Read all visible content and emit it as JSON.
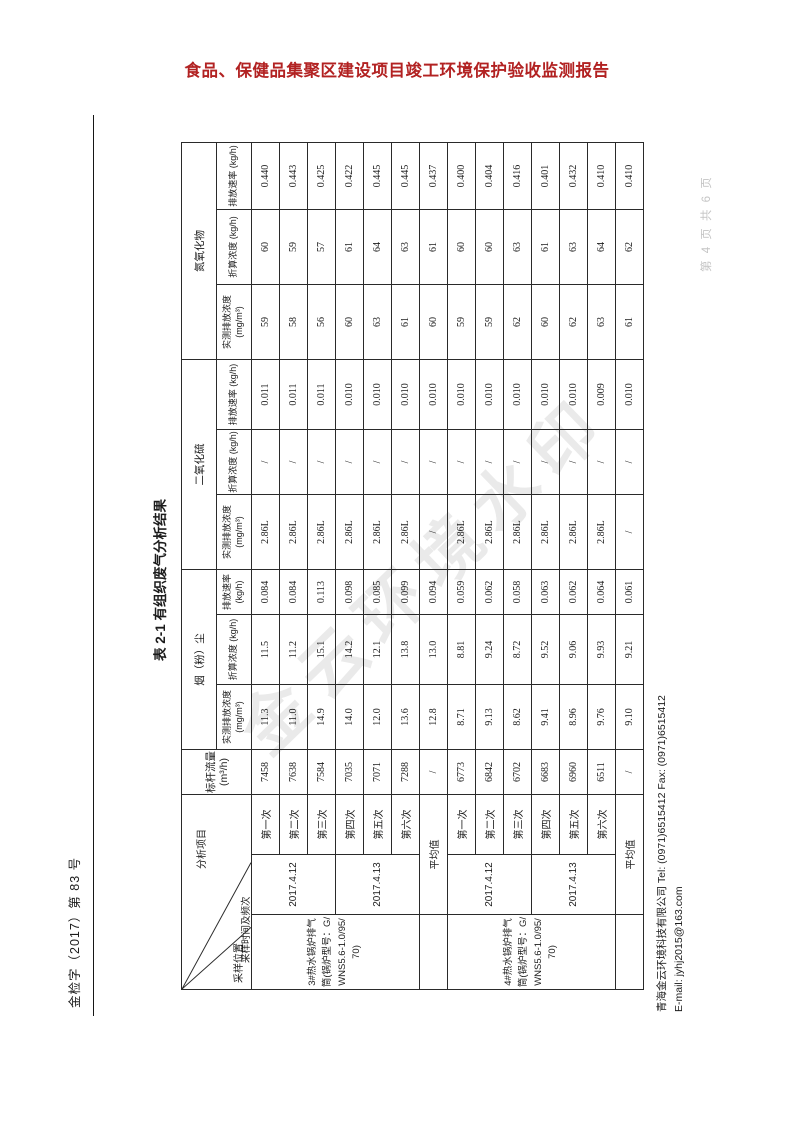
{
  "page": {
    "doc_header": "食品、保健品集聚区建设项目竣工环境保护验收监测报告",
    "ref_number": "金检字（2017）第 83 号",
    "page_number": "第 4 页 共 6 页",
    "watermark": "金云环境水印",
    "footer_line1": "青海金云环境科技有限公司 Tel: (0971)6515412  Fax: (0971)6515412",
    "footer_line2": "E-mail: jyhj2015@163.com"
  },
  "colors": {
    "doc_header_red": "#b22222",
    "table_border": "#2a2a2a",
    "watermark_gray": "rgba(125,125,125,0.16)"
  },
  "table": {
    "title": "表 2-1 有组织废气分析结果",
    "header": {
      "diag": [
        "采样位置",
        "采样时间及频次",
        "分析项目"
      ],
      "flow_label": "标杆流量 (m³/h)",
      "groups": [
        "烟（粉）尘",
        "二氧化硫",
        "氮氧化物"
      ],
      "sub": [
        "实测排放浓度 (mg/m³)",
        "折算浓度 (kg/h)",
        "排放速率 (kg/h)"
      ]
    },
    "sections": [
      {
        "location": "3#热水锅炉排气筒(锅炉型号：G/WNS5.6-1.0/95/70)",
        "dates": [
          {
            "date": "2017.4.12",
            "rows": [
              {
                "seq": "第一次",
                "flow": "7458",
                "dust": [
                  "11.3",
                  "11.5",
                  "0.084"
                ],
                "so2": [
                  "2.86L",
                  "/",
                  "0.011"
                ],
                "nox": [
                  "59",
                  "60",
                  "0.440"
                ]
              },
              {
                "seq": "第二次",
                "flow": "7638",
                "dust": [
                  "11.0",
                  "11.2",
                  "0.084"
                ],
                "so2": [
                  "2.86L",
                  "/",
                  "0.011"
                ],
                "nox": [
                  "58",
                  "59",
                  "0.443"
                ]
              },
              {
                "seq": "第三次",
                "flow": "7584",
                "dust": [
                  "14.9",
                  "15.1",
                  "0.113"
                ],
                "so2": [
                  "2.86L",
                  "/",
                  "0.011"
                ],
                "nox": [
                  "56",
                  "57",
                  "0.425"
                ]
              }
            ]
          },
          {
            "date": "2017.4.13",
            "rows": [
              {
                "seq": "第四次",
                "flow": "7035",
                "dust": [
                  "14.0",
                  "14.2",
                  "0.098"
                ],
                "so2": [
                  "2.86L",
                  "/",
                  "0.010"
                ],
                "nox": [
                  "60",
                  "61",
                  "0.422"
                ]
              },
              {
                "seq": "第五次",
                "flow": "7071",
                "dust": [
                  "12.0",
                  "12.1",
                  "0.085"
                ],
                "so2": [
                  "2.86L",
                  "/",
                  "0.010"
                ],
                "nox": [
                  "63",
                  "64",
                  "0.445"
                ]
              },
              {
                "seq": "第六次",
                "flow": "7288",
                "dust": [
                  "13.6",
                  "13.8",
                  "0.099"
                ],
                "so2": [
                  "2.86L",
                  "/",
                  "0.010"
                ],
                "nox": [
                  "61",
                  "63",
                  "0.445"
                ]
              }
            ]
          }
        ],
        "average": {
          "label": "平均值",
          "flow": "/",
          "dust": [
            "12.8",
            "13.0",
            "0.094"
          ],
          "so2": [
            "/",
            "/",
            "0.010"
          ],
          "nox": [
            "60",
            "61",
            "0.437"
          ]
        }
      },
      {
        "location": "4#热水锅炉排气筒(锅炉型号：G/WNS5.6-1.0/95/70)",
        "dates": [
          {
            "date": "2017.4.12",
            "rows": [
              {
                "seq": "第一次",
                "flow": "6773",
                "dust": [
                  "8.71",
                  "8.81",
                  "0.059"
                ],
                "so2": [
                  "2.86L",
                  "/",
                  "0.010"
                ],
                "nox": [
                  "59",
                  "60",
                  "0.400"
                ]
              },
              {
                "seq": "第二次",
                "flow": "6842",
                "dust": [
                  "9.13",
                  "9.24",
                  "0.062"
                ],
                "so2": [
                  "2.86L",
                  "/",
                  "0.010"
                ],
                "nox": [
                  "59",
                  "60",
                  "0.404"
                ]
              },
              {
                "seq": "第三次",
                "flow": "6702",
                "dust": [
                  "8.62",
                  "8.72",
                  "0.058"
                ],
                "so2": [
                  "2.86L",
                  "/",
                  "0.010"
                ],
                "nox": [
                  "62",
                  "63",
                  "0.416"
                ]
              }
            ]
          },
          {
            "date": "2017.4.13",
            "rows": [
              {
                "seq": "第四次",
                "flow": "6683",
                "dust": [
                  "9.41",
                  "9.52",
                  "0.063"
                ],
                "so2": [
                  "2.86L",
                  "/",
                  "0.010"
                ],
                "nox": [
                  "60",
                  "61",
                  "0.401"
                ]
              },
              {
                "seq": "第五次",
                "flow": "6960",
                "dust": [
                  "8.96",
                  "9.06",
                  "0.062"
                ],
                "so2": [
                  "2.86L",
                  "/",
                  "0.010"
                ],
                "nox": [
                  "62",
                  "63",
                  "0.432"
                ]
              },
              {
                "seq": "第六次",
                "flow": "6511",
                "dust": [
                  "9.76",
                  "9.93",
                  "0.064"
                ],
                "so2": [
                  "2.86L",
                  "/",
                  "0.009"
                ],
                "nox": [
                  "63",
                  "64",
                  "0.410"
                ]
              }
            ]
          }
        ],
        "average": {
          "label": "平均值",
          "flow": "/",
          "dust": [
            "9.10",
            "9.21",
            "0.061"
          ],
          "so2": [
            "/",
            "/",
            "0.010"
          ],
          "nox": [
            "61",
            "62",
            "0.410"
          ]
        }
      }
    ]
  }
}
